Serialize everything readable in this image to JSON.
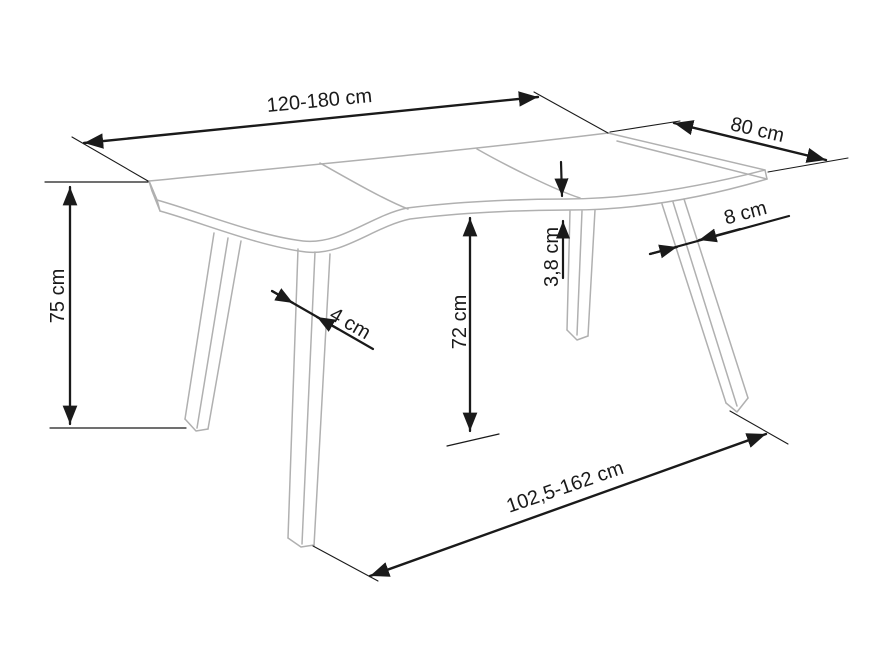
{
  "drawing": {
    "kind": "furniture-dimension-diagram",
    "object": "table"
  },
  "colors": {
    "background": "#ffffff",
    "table_lines": "#b0b0b0",
    "dimension_lines": "#1a1a1a",
    "label_text": "#1a1a1a"
  },
  "dimensions": {
    "table_length_top": "120-180 cm",
    "table_depth": "80 cm",
    "table_height": "75 cm",
    "clearance_under_top": "72 cm",
    "top_thickness": "3,8 cm",
    "front_leg_width": "4 cm",
    "side_leg_width": "8 cm",
    "leg_span_bottom": "102,5-162 cm"
  }
}
